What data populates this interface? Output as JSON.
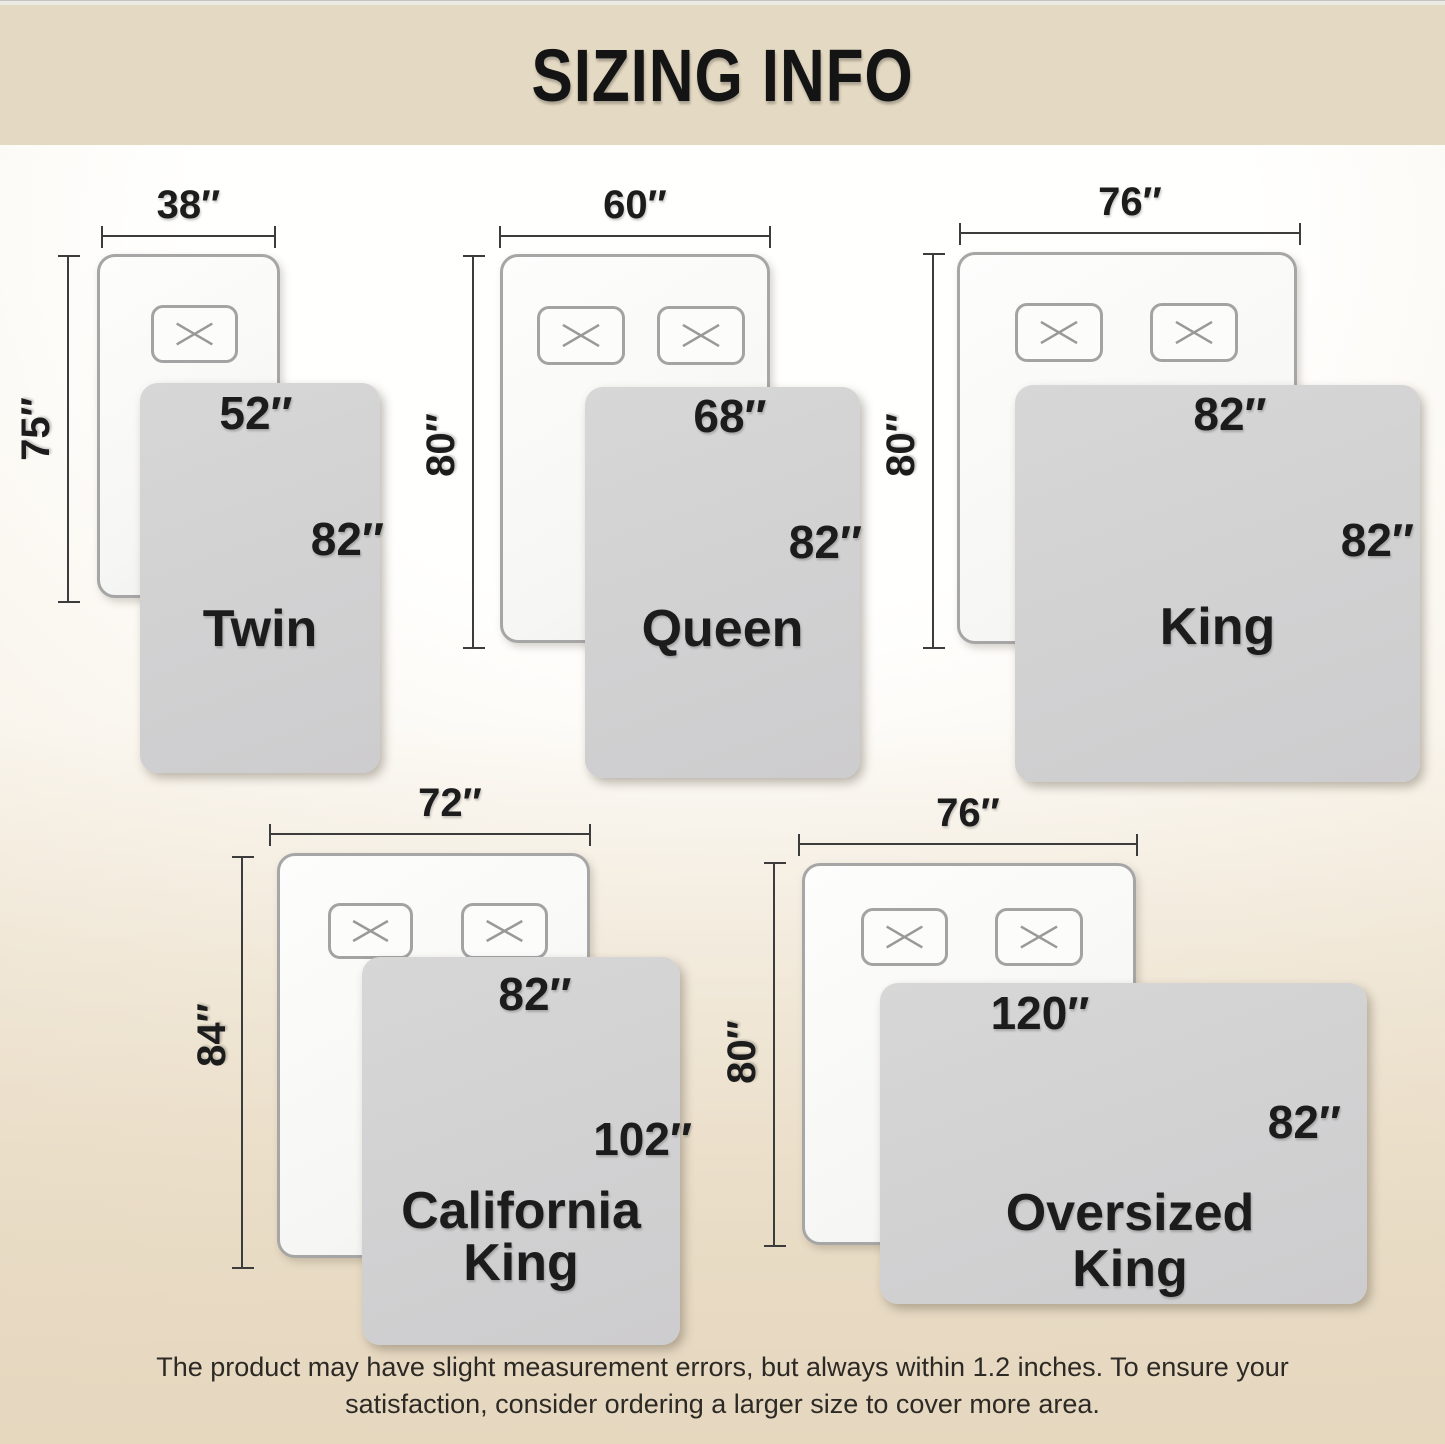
{
  "header": {
    "title": "SIZING INFO"
  },
  "footer": {
    "line1": "The product may have slight measurement errors, but always within 1.2 inches. To ensure your",
    "line2": "satisfaction, consider ordering a larger size to cover more area."
  },
  "beds": [
    {
      "name_lines": [
        "Twin"
      ],
      "mattress_width": "38″",
      "mattress_length": "75″",
      "blanket_width": "52″",
      "blanket_length": "82″",
      "pillows": 1
    },
    {
      "name_lines": [
        "Queen"
      ],
      "mattress_width": "60″",
      "mattress_length": "80″",
      "blanket_width": "68″",
      "blanket_length": "82″",
      "pillows": 2
    },
    {
      "name_lines": [
        "King"
      ],
      "mattress_width": "76″",
      "mattress_length": "80″",
      "blanket_width": "82″",
      "blanket_length": "82″",
      "pillows": 2
    },
    {
      "name_lines": [
        "California",
        "King"
      ],
      "mattress_width": "72″",
      "mattress_length": "84″",
      "blanket_width": "82″",
      "blanket_length": "102″",
      "pillows": 2
    },
    {
      "name_lines": [
        "Oversized",
        "King"
      ],
      "mattress_width": "76″",
      "mattress_length": "80″",
      "blanket_width": "120″",
      "blanket_length": "82″",
      "pillows": 2
    }
  ],
  "colors": {
    "header_bg": "#e4d9c3",
    "background_bottom": "#e6d7bf",
    "blanket": "#d2d2d2",
    "mattress": "#fbfbfa",
    "dim_line": "#3c3c3c",
    "text": "#1c1c1c"
  }
}
